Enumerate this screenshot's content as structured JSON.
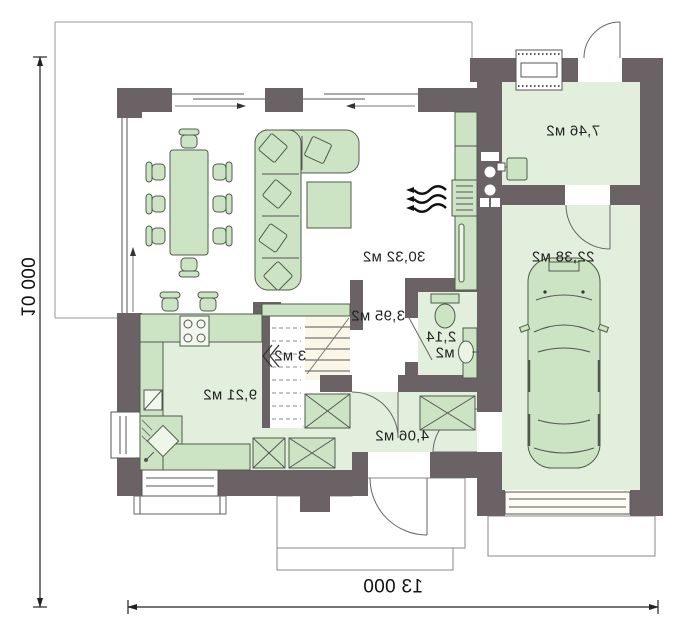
{
  "plan": {
    "rooms": {
      "living": {
        "label": "30,32 м2"
      },
      "garage": {
        "label": "22,38 м2"
      },
      "vestibule": {
        "label": "7,46 м2"
      },
      "kitchen": {
        "label": "9,21 м2"
      },
      "hall": {
        "label": "4,06 м2"
      },
      "stair_hall": {
        "label": "3,95 м2"
      },
      "pantry": {
        "label": "3 м2"
      },
      "wc": {
        "label_line1": "2,14",
        "label_line2": "м2"
      }
    },
    "dimensions": {
      "width": "13 000",
      "height": "10 000"
    },
    "colors": {
      "wall": "#6a6264",
      "floor": "#e3efdd",
      "furniture": "#cde4c4",
      "outline": "#8a8a8a"
    }
  }
}
